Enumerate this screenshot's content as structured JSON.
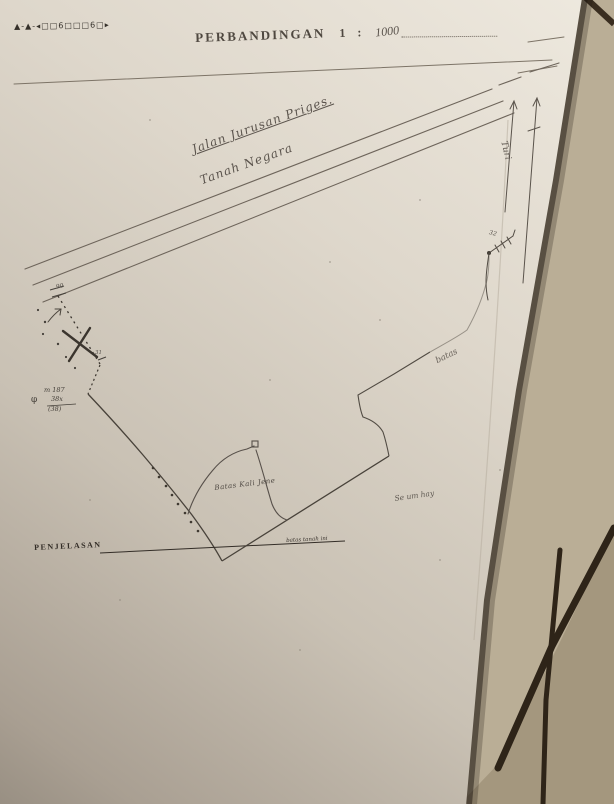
{
  "header": {
    "corner_marks": "▲-▲-◂□□6□□□6□▸",
    "title": "PERBANDINGAN",
    "scale_number": "1",
    "colon": ":",
    "scale_value": "1000"
  },
  "map": {
    "road_label_line1": "Jalan Jurusan Priges.",
    "road_label_line2": "Tanah Negara",
    "direction_label": "Turi",
    "point_label_32": "32",
    "corner_label_90": "90",
    "corner_label_31": "31",
    "marker_m": "m 187",
    "marker_phi": "φ",
    "marker_fraction_top": "38x",
    "marker_fraction_bottom": "(38)",
    "boundary_label": "batas",
    "river_label": "Batas Kali Jene",
    "field_label": "Se um hay",
    "note_on_line": "batas tanah ini"
  },
  "legend": {
    "title": "PENJELASAN"
  },
  "colors": {
    "paper_light": "#eee9df",
    "paper_dark": "#877f73",
    "ink": "#4a443b",
    "ink_faint": "#7d7467",
    "floor_tile": "#baae96",
    "floor_tile_dark": "#a4977e",
    "grout": "#2e2418"
  }
}
